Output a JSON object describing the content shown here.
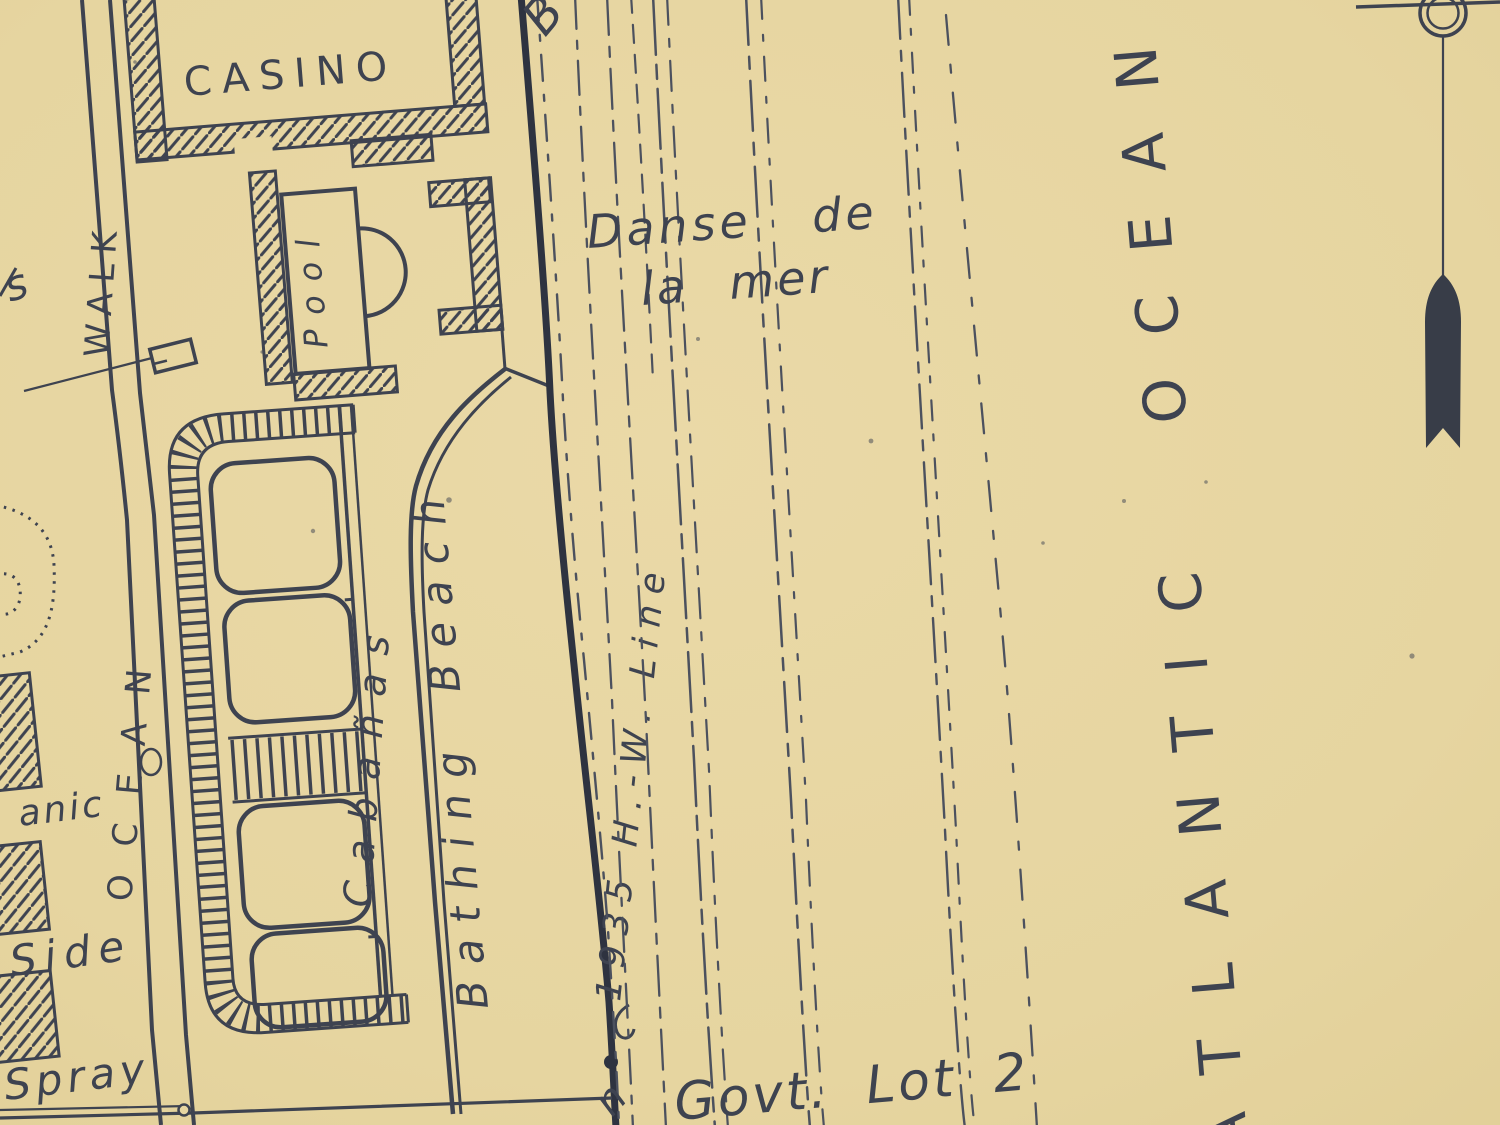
{
  "map": {
    "title": "beach resort plat map",
    "labels": {
      "casino": "CASINO",
      "pool": "Pool",
      "walk": "WALK",
      "ocean": "OCEAN",
      "cabanas": "Cabañas",
      "bathing_beach": "Bathing Beach",
      "danse_line1": "Danse de",
      "danse_line2": "la mer",
      "high_water_line": "1935 H.-W. Line",
      "govt_lot": "Govt. Lot 2",
      "atlantic_ocean": "ATLANTIC OCEAN",
      "fragment_top_b": "B",
      "fragment_left_s": "s",
      "fragment_bottom_n": "n",
      "fragment_oceanic": "anic",
      "fragment_side": "Side",
      "fragment_spray": "Spray"
    },
    "icons": {
      "compass": "compass-needle-icon"
    },
    "colors": {
      "paper": "#e7d6a1",
      "ink": "#3e4350",
      "ink_dark": "#2e3340",
      "contour": "#4c515e"
    }
  }
}
